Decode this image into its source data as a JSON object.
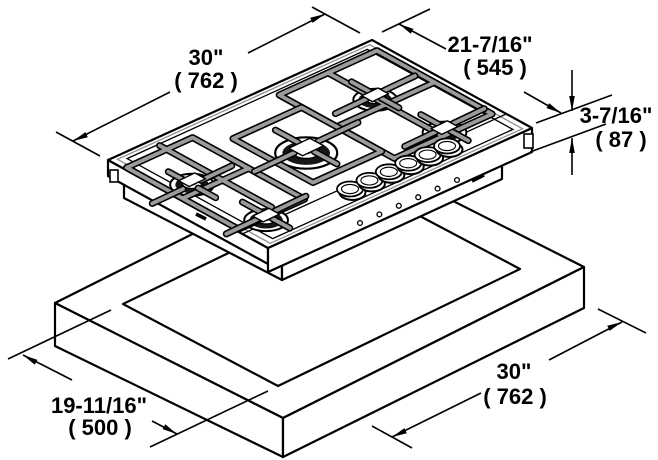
{
  "diagram": {
    "type": "isometric-installation-drawing",
    "subject": "5-burner gas cooktop above countertop cutout",
    "dimensions": {
      "top_width": {
        "inches": "30\"",
        "mm": "( 762 )"
      },
      "top_depth": {
        "inches": "21-7/16\"",
        "mm": "( 545 )"
      },
      "height": {
        "inches": "3-7/16\"",
        "mm": "( 87 )"
      },
      "cutout_depth": {
        "inches": "19-11/16\"",
        "mm": "( 500 )"
      },
      "cutout_width": {
        "inches": "30\"",
        "mm": "( 762 )"
      }
    }
  }
}
